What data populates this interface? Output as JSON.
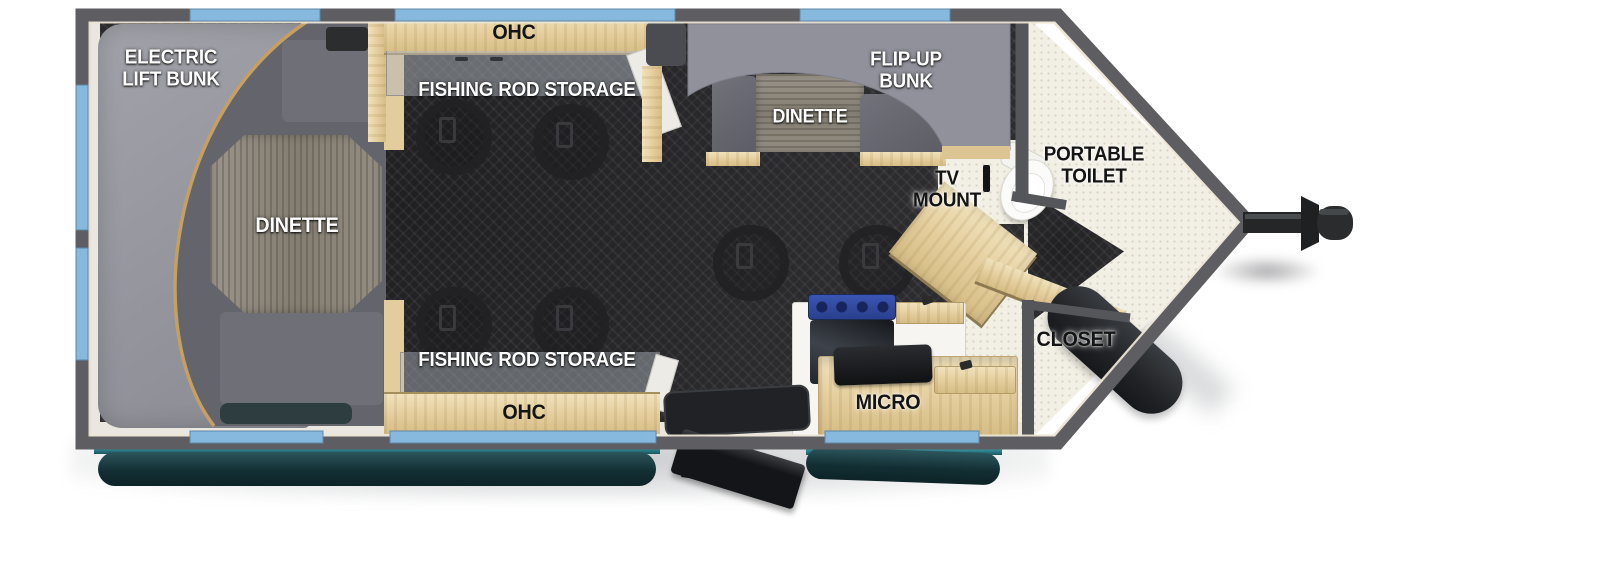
{
  "floorplan": {
    "title": "travel trailer floor plan (toy-hauler style with V-front)",
    "labels": {
      "electric_lift_bunk": {
        "line1": "ELECTRIC",
        "line2": "LIFT BUNK"
      },
      "ohc_top": "OHC",
      "fishing_rod_storage_top": "FISHING ROD STORAGE",
      "dinette_left": "DINETTE",
      "flip_up_bunk": {
        "line1": "FLIP-UP",
        "line2": "BUNK"
      },
      "dinette_right": "DINETTE",
      "tv_mount": {
        "line1": "TV",
        "line2": "MOUNT"
      },
      "portable_toilet": {
        "line1": "PORTABLE",
        "line2": "TOILET"
      },
      "closet": "CLOSET",
      "micro": "MICRO",
      "fishing_rod_storage_bottom": "FISHING ROD STORAGE",
      "ohc_bottom": "OHC"
    },
    "colors": {
      "wall_gray": "#5e5e62",
      "inner_trim": "#ece4d4",
      "floor_dark": "#2c2c2f",
      "nose_floor_cream": "#f2efe5",
      "wood_cabinet": "#e7d3a3",
      "seat_gray": "#64646d",
      "bunk_light_gray": "#97979f",
      "window_blue": "#86b9dd",
      "awning_teal_bright": "#4cc0cf",
      "awning_teal_dark": "#123136",
      "cooktop_blue": "#31489c",
      "hitch_black": "#242628",
      "table_wood_gray": "#8a8478"
    }
  }
}
